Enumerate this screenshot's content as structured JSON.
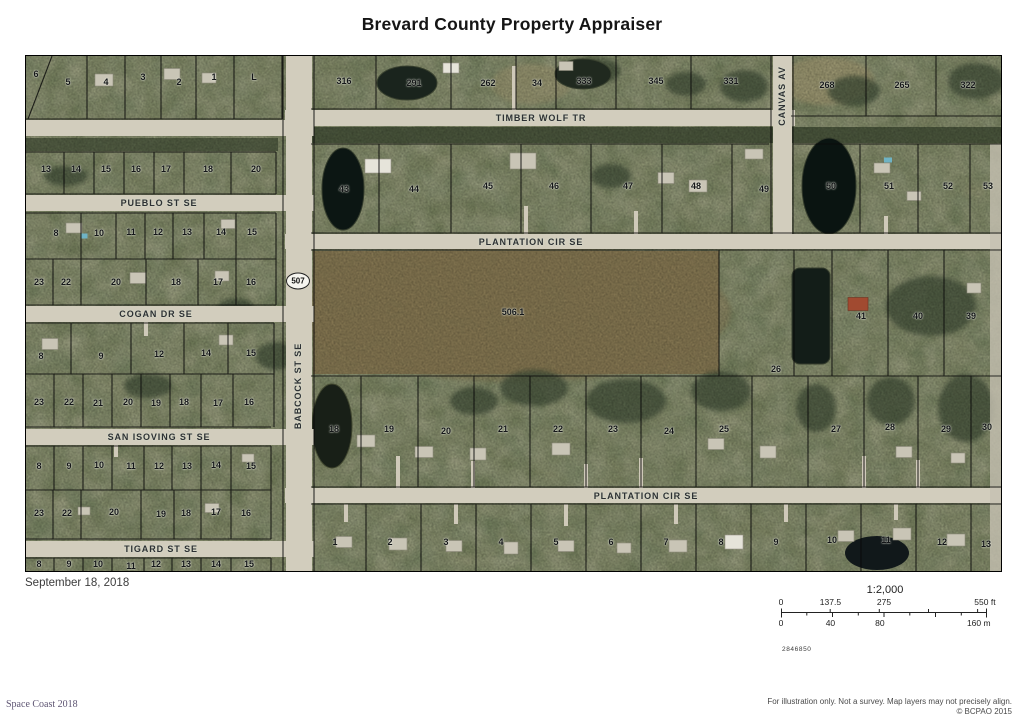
{
  "header": {
    "title": "Brevard County Property Appraiser"
  },
  "map": {
    "date": "September 18, 2018",
    "route_shield": "507",
    "streets": [
      {
        "name": "TIMBER WOLF TR",
        "x": 515,
        "y": 62,
        "vertical": false
      },
      {
        "name": "PUEBLO ST SE",
        "x": 133,
        "y": 147,
        "vertical": false
      },
      {
        "name": "PLANTATION CIR SE",
        "x": 505,
        "y": 186,
        "vertical": false
      },
      {
        "name": "COGAN DR SE",
        "x": 130,
        "y": 258,
        "vertical": false
      },
      {
        "name": "SAN ISOVING ST SE",
        "x": 133,
        "y": 381,
        "vertical": false
      },
      {
        "name": "PLANTATION CIR SE",
        "x": 620,
        "y": 440,
        "vertical": false
      },
      {
        "name": "TIGARD ST SE",
        "x": 135,
        "y": 493,
        "vertical": false
      },
      {
        "name": "BABCOCK ST SE",
        "x": 272,
        "y": 330,
        "vertical": true
      },
      {
        "name": "CANVAS AV",
        "x": 756,
        "y": 40,
        "vertical": true
      }
    ],
    "lots": [
      [
        "6",
        10,
        18
      ],
      [
        "5",
        42,
        26
      ],
      [
        "4",
        80,
        26
      ],
      [
        "3",
        117,
        21
      ],
      [
        "2",
        153,
        26
      ],
      [
        "1",
        188,
        21
      ],
      [
        "L",
        228,
        21
      ],
      [
        "13",
        20,
        113
      ],
      [
        "14",
        50,
        113
      ],
      [
        "15",
        80,
        113
      ],
      [
        "16",
        110,
        113
      ],
      [
        "17",
        140,
        113
      ],
      [
        "18",
        182,
        113
      ],
      [
        "20",
        230,
        113
      ],
      [
        "8",
        30,
        177
      ],
      [
        "10",
        73,
        177
      ],
      [
        "11",
        105,
        176
      ],
      [
        "12",
        132,
        176
      ],
      [
        "13",
        161,
        176
      ],
      [
        "14",
        195,
        176
      ],
      [
        "15",
        226,
        176
      ],
      [
        "23",
        13,
        226
      ],
      [
        "22",
        40,
        226
      ],
      [
        "20",
        90,
        226
      ],
      [
        "18",
        150,
        226
      ],
      [
        "17",
        192,
        226
      ],
      [
        "16",
        225,
        226
      ],
      [
        "8",
        15,
        300
      ],
      [
        "9",
        75,
        300
      ],
      [
        "12",
        133,
        298
      ],
      [
        "14",
        180,
        297
      ],
      [
        "15",
        225,
        297
      ],
      [
        "23",
        13,
        346
      ],
      [
        "22",
        43,
        346
      ],
      [
        "21",
        72,
        347
      ],
      [
        "20",
        102,
        346
      ],
      [
        "19",
        130,
        347
      ],
      [
        "18",
        158,
        346
      ],
      [
        "17",
        192,
        347
      ],
      [
        "16",
        223,
        346
      ],
      [
        "8",
        13,
        410
      ],
      [
        "9",
        43,
        410
      ],
      [
        "10",
        73,
        409
      ],
      [
        "11",
        105,
        410
      ],
      [
        "12",
        133,
        410
      ],
      [
        "13",
        161,
        410
      ],
      [
        "14",
        190,
        409
      ],
      [
        "15",
        225,
        410
      ],
      [
        "23",
        13,
        457
      ],
      [
        "22",
        41,
        457
      ],
      [
        "20",
        88,
        456
      ],
      [
        "19",
        135,
        458
      ],
      [
        "18",
        160,
        457
      ],
      [
        "17",
        190,
        456
      ],
      [
        "16",
        220,
        457
      ],
      [
        "8",
        13,
        508
      ],
      [
        "9",
        43,
        508
      ],
      [
        "10",
        72,
        508
      ],
      [
        "11",
        105,
        510
      ],
      [
        "12",
        130,
        508
      ],
      [
        "13",
        160,
        508
      ],
      [
        "14",
        190,
        508
      ],
      [
        "15",
        223,
        508
      ],
      [
        "316",
        318,
        25
      ],
      [
        "291",
        388,
        27
      ],
      [
        "262",
        462,
        27
      ],
      [
        "34",
        511,
        27
      ],
      [
        "333",
        558,
        25
      ],
      [
        "345",
        630,
        25
      ],
      [
        "331",
        705,
        25
      ],
      [
        "268",
        801,
        29
      ],
      [
        "265",
        876,
        29
      ],
      [
        "322",
        942,
        29
      ],
      [
        "43",
        318,
        133
      ],
      [
        "44",
        388,
        133
      ],
      [
        "45",
        462,
        130
      ],
      [
        "46",
        528,
        130
      ],
      [
        "47",
        602,
        130
      ],
      [
        "48",
        670,
        130
      ],
      [
        "49",
        738,
        133
      ],
      [
        "50",
        805,
        130
      ],
      [
        "51",
        863,
        130
      ],
      [
        "52",
        922,
        130
      ],
      [
        "53",
        962,
        130
      ],
      [
        "506.1",
        487,
        256
      ],
      [
        "26",
        750,
        313
      ],
      [
        "41",
        835,
        260
      ],
      [
        "40",
        892,
        260
      ],
      [
        "39",
        945,
        260
      ],
      [
        "18",
        308,
        373
      ],
      [
        "19",
        363,
        373
      ],
      [
        "20",
        420,
        375
      ],
      [
        "21",
        477,
        373
      ],
      [
        "22",
        532,
        373
      ],
      [
        "23",
        587,
        373
      ],
      [
        "24",
        643,
        375
      ],
      [
        "25",
        698,
        373
      ],
      [
        "27",
        810,
        373
      ],
      [
        "28",
        864,
        371
      ],
      [
        "29",
        920,
        373
      ],
      [
        "30",
        961,
        371
      ],
      [
        "1",
        309,
        486
      ],
      [
        "2",
        364,
        486
      ],
      [
        "3",
        420,
        486
      ],
      [
        "4",
        475,
        486
      ],
      [
        "5",
        530,
        486
      ],
      [
        "6",
        585,
        486
      ],
      [
        "7",
        640,
        486
      ],
      [
        "8",
        695,
        486
      ],
      [
        "9",
        750,
        486
      ],
      [
        "10",
        806,
        484
      ],
      [
        "11",
        860,
        484
      ],
      [
        "12",
        916,
        486
      ],
      [
        "13",
        960,
        488
      ]
    ]
  },
  "scalebar": {
    "ratio": "1:2,000",
    "ft": [
      {
        "label": "0",
        "pct": 0
      },
      {
        "label": "137.5",
        "pct": 24
      },
      {
        "label": "275",
        "pct": 50
      },
      {
        "label": "550 ft",
        "pct": 99
      }
    ],
    "m": [
      {
        "label": "0",
        "pct": 0
      },
      {
        "label": "40",
        "pct": 24
      },
      {
        "label": "80",
        "pct": 48
      },
      {
        "label": "160 m",
        "pct": 96
      }
    ],
    "map_number": "2846850"
  },
  "footer": {
    "credit": "Space Coast 2018",
    "disclaimer": "For illustration only. Not a survey. Map layers may not precisely align.",
    "copyright": "© BCPAO 2015"
  }
}
